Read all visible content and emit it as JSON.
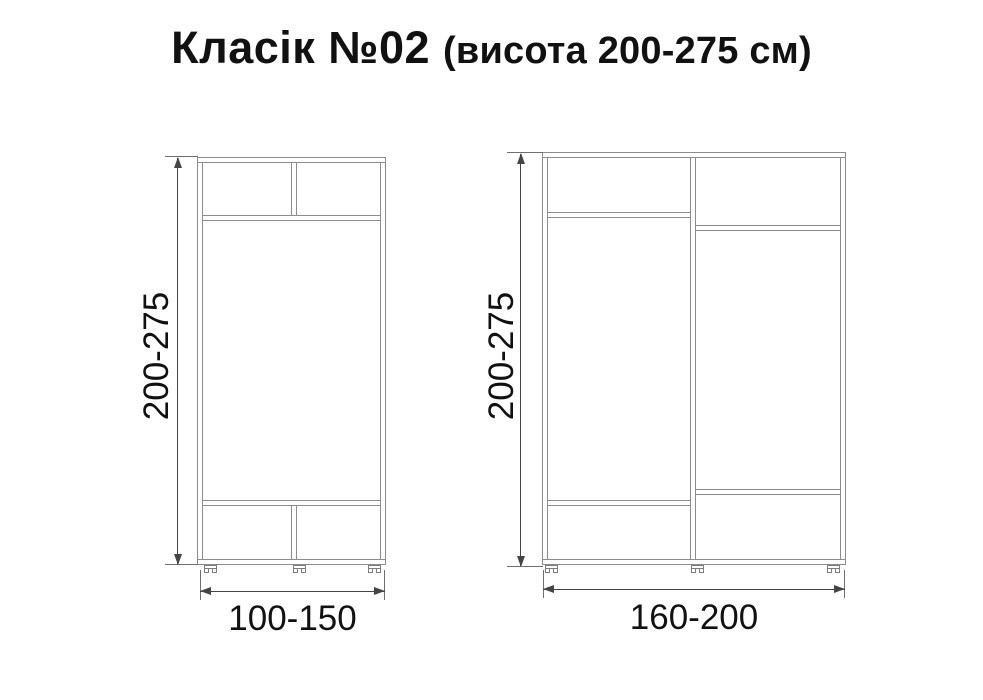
{
  "title": {
    "name": "Класік №02",
    "suffix": "(висота 200-275 см)"
  },
  "diagrams": {
    "left": {
      "height_label": "200-275",
      "width_label": "100-150"
    },
    "right": {
      "height_label": "200-275",
      "width_label": "160-200"
    }
  },
  "colors": {
    "panel_line": "#8c8c8c",
    "dimension_line": "#454545",
    "text": "#111111",
    "background": "#ffffff"
  }
}
